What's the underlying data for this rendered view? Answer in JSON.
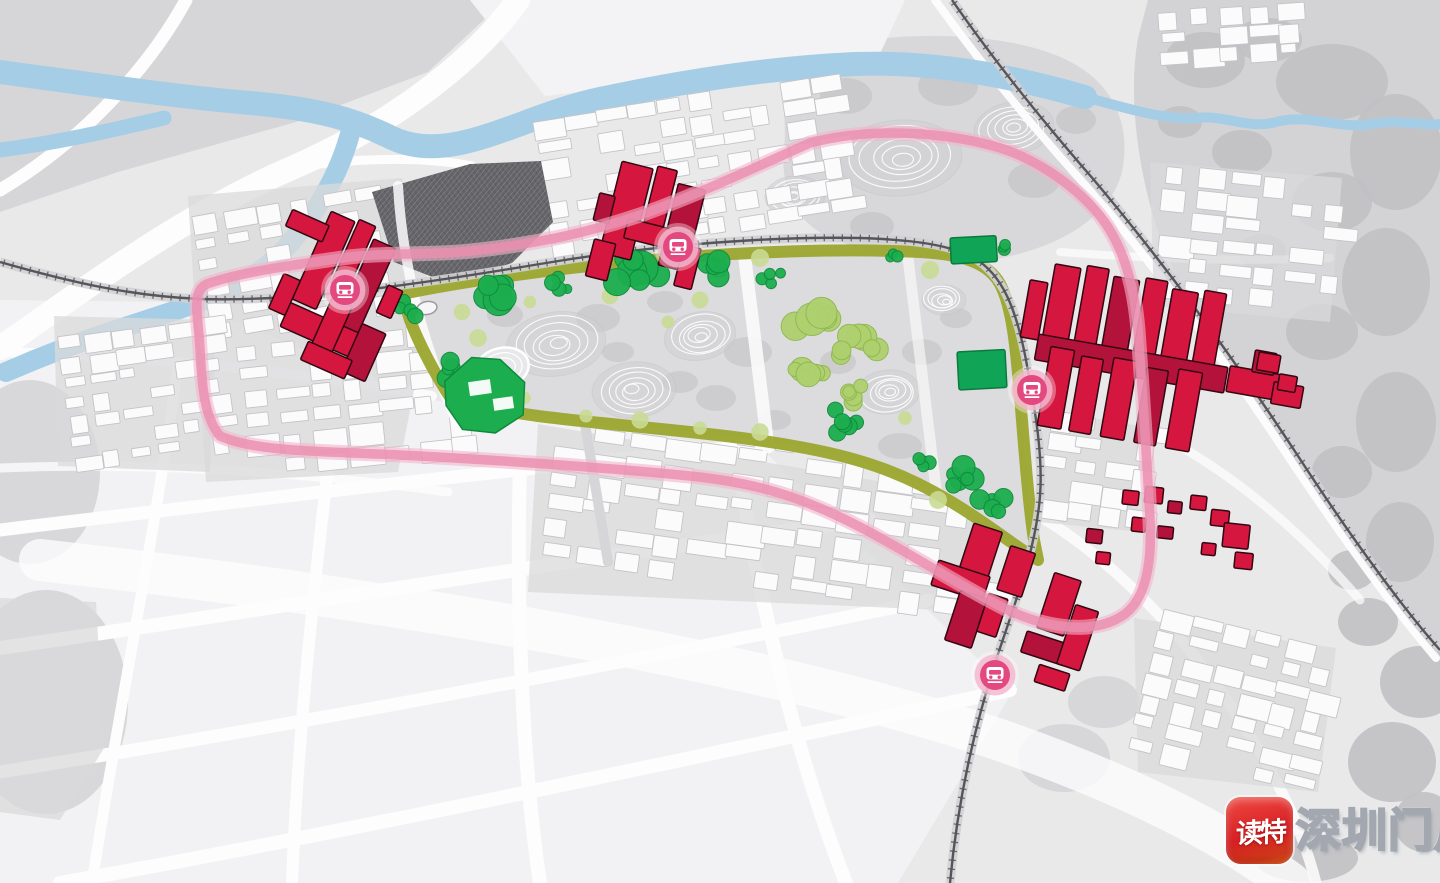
{
  "title": "urban-park-masterplan-rendering",
  "colors": {
    "background": "#e9e9ea",
    "terrain_gray": "#d6d6d8",
    "blob_gray": "#c1c1c4",
    "park_fill": "#dcdcde",
    "river_blue": "#a6cde6",
    "road_white": "#fdfdfe",
    "rail_dark": "#55555a",
    "rail_bed": "#d2d2d5",
    "pink_line": "#eb8fb0",
    "pink_line_soft": "#f2b4ca",
    "greenway_olive": "#9da733",
    "tree_green": "#1cae4e",
    "tree_green_dark": "#0f8a3c",
    "tree_light": "#aed06e",
    "tree_light_blob": "#c9da93",
    "green_building": "#10a556",
    "red_building": "#d5163e",
    "red_building_dark": "#b3123a",
    "building_outline": "#320712",
    "station_pink": "#e3487f",
    "station_ring": "#f4b6cd",
    "white_block": "#fbfbfc",
    "white_block_outline": "#c4c4c8",
    "village_dark": "#66666a",
    "parcel_gray": "#d9d9db"
  },
  "watermark": {
    "app_name": "读特",
    "site_name": "深圳门户"
  },
  "transit": {
    "stations": [
      {
        "id": "west-station",
        "x": 345,
        "y": 290
      },
      {
        "id": "north-station",
        "x": 678,
        "y": 247
      },
      {
        "id": "east-station",
        "x": 1032,
        "y": 390
      },
      {
        "id": "south-station",
        "x": 995,
        "y": 675
      }
    ]
  },
  "park": {
    "hills": [
      [
        556,
        344,
        50,
        32,
        -8
      ],
      [
        634,
        390,
        42,
        28,
        -5
      ],
      [
        700,
        336,
        36,
        24,
        -10
      ],
      [
        888,
        392,
        32,
        22,
        -6
      ],
      [
        944,
        300,
        22,
        15,
        0
      ]
    ],
    "gray_blobs": [
      [
        505,
        315,
        18,
        12
      ],
      [
        598,
        318,
        22,
        14
      ],
      [
        665,
        302,
        18,
        11
      ],
      [
        748,
        352,
        24,
        15
      ],
      [
        716,
        398,
        20,
        13
      ],
      [
        775,
        420,
        16,
        10
      ],
      [
        838,
        362,
        18,
        12
      ],
      [
        922,
        352,
        20,
        13
      ],
      [
        956,
        318,
        16,
        10
      ],
      [
        900,
        446,
        22,
        13
      ],
      [
        618,
        352,
        16,
        10
      ],
      [
        680,
        382,
        18,
        11
      ]
    ],
    "tree_clusters_dark": [
      [
        500,
        291,
        24,
        7
      ],
      [
        560,
        283,
        13,
        4
      ],
      [
        636,
        270,
        26,
        8
      ],
      [
        716,
        266,
        18,
        6
      ],
      [
        772,
        276,
        12,
        4
      ],
      [
        412,
        308,
        14,
        5
      ],
      [
        452,
        370,
        15,
        5
      ],
      [
        838,
        420,
        20,
        6
      ],
      [
        962,
        478,
        18,
        6
      ],
      [
        992,
        502,
        16,
        5
      ],
      [
        930,
        462,
        12,
        4
      ],
      [
        1002,
        248,
        10,
        3
      ],
      [
        340,
        340,
        10,
        3
      ],
      [
        892,
        254,
        9,
        3
      ]
    ],
    "tree_clusters_light": [
      [
        818,
        318,
        26,
        7
      ],
      [
        862,
        348,
        24,
        7
      ],
      [
        806,
        372,
        20,
        6
      ],
      [
        850,
        392,
        16,
        5
      ]
    ],
    "light_blobs": [
      [
        462,
        312
      ],
      [
        530,
        302
      ],
      [
        610,
        296
      ],
      [
        668,
        322
      ],
      [
        700,
        300
      ],
      [
        586,
        416
      ],
      [
        640,
        420
      ],
      [
        700,
        428
      ],
      [
        760,
        432
      ],
      [
        524,
        398
      ],
      [
        478,
        338
      ],
      [
        905,
        418
      ],
      [
        938,
        500
      ],
      [
        600,
        262
      ],
      [
        760,
        258
      ],
      [
        690,
        256
      ],
      [
        930,
        270
      ]
    ],
    "green_buildings": [
      [
        950,
        238,
        46,
        26,
        -3
      ],
      [
        957,
        352,
        48,
        38,
        -3
      ]
    ],
    "running_track": {
      "cx": 502,
      "cy": 368,
      "rx": 27,
      "ry": 20,
      "rot": -14
    },
    "pond": {
      "cx": 427,
      "cy": 308,
      "rx": 10,
      "ry": 6.5,
      "rot": -10
    }
  },
  "terrain": {
    "north_hills": [
      [
        900,
        158,
        62,
        38,
        -4
      ],
      [
        1014,
        128,
        40,
        26,
        -8
      ],
      [
        795,
        196,
        30,
        20,
        -4
      ]
    ],
    "north_blobs": [
      [
        846,
        96,
        26,
        18
      ],
      [
        948,
        86,
        30,
        20
      ],
      [
        1034,
        180,
        26,
        18
      ],
      [
        872,
        226,
        22,
        14
      ],
      [
        1076,
        120,
        20,
        14
      ]
    ],
    "east_canopy_blobs": [
      [
        1205,
        60,
        40,
        28
      ],
      [
        1268,
        40,
        34,
        22
      ],
      [
        1332,
        82,
        56,
        38
      ],
      [
        1396,
        152,
        46,
        58
      ],
      [
        1332,
        202,
        40,
        30
      ],
      [
        1242,
        152,
        30,
        22
      ],
      [
        1386,
        282,
        44,
        54
      ],
      [
        1322,
        332,
        36,
        28
      ],
      [
        1396,
        422,
        40,
        50
      ],
      [
        1342,
        472,
        30,
        26
      ],
      [
        1400,
        542,
        34,
        40
      ],
      [
        1262,
        252,
        24,
        18
      ],
      [
        1222,
        212,
        20,
        16
      ],
      [
        1180,
        122,
        22,
        16
      ],
      [
        1368,
        622,
        30,
        24
      ],
      [
        1420,
        682,
        40,
        36
      ],
      [
        1392,
        762,
        44,
        40
      ],
      [
        1306,
        858,
        52,
        24
      ],
      [
        1424,
        822,
        30,
        30
      ],
      [
        1352,
        570,
        24,
        20
      ]
    ],
    "misc_blobs": [
      [
        30,
        472,
        70,
        92
      ],
      [
        46,
        702,
        82,
        112
      ],
      [
        1064,
        758,
        46,
        34
      ],
      [
        1104,
        702,
        36,
        26
      ]
    ]
  },
  "red_clusters": [
    {
      "id": "west-cluster",
      "rot": 24,
      "cx": 340,
      "cy": 295,
      "bars": [
        [
          298,
          222,
          26,
          96
        ],
        [
          327,
          218,
          18,
          70
        ],
        [
          348,
          230,
          24,
          102
        ],
        [
          298,
          322,
          88,
          26
        ],
        [
          334,
          300,
          22,
          62
        ],
        [
          280,
          298,
          18,
          38
        ],
        [
          372,
          312,
          26,
          52
        ],
        [
          330,
          350,
          48,
          20
        ],
        [
          380,
          266,
          16,
          30
        ],
        [
          262,
          236,
          40,
          18
        ]
      ]
    },
    {
      "id": "north-cluster",
      "rot": 14,
      "cx": 652,
      "cy": 215,
      "bars": [
        [
          610,
          170,
          32,
          94
        ],
        [
          646,
          166,
          20,
          58
        ],
        [
          670,
          178,
          28,
          84
        ],
        [
          602,
          252,
          22,
          38
        ],
        [
          630,
          224,
          60,
          20
        ],
        [
          690,
          236,
          18,
          42
        ],
        [
          596,
          206,
          16,
          28
        ]
      ]
    },
    {
      "id": "east-cluster",
      "rot": 10,
      "cx": 1140,
      "cy": 360,
      "bars": [
        [
          1040,
          280,
          26,
          88
        ],
        [
          1072,
          276,
          22,
          92
        ],
        [
          1100,
          282,
          26,
          86
        ],
        [
          1132,
          278,
          22,
          90
        ],
        [
          1160,
          284,
          26,
          84
        ],
        [
          1192,
          280,
          22,
          88
        ],
        [
          1036,
          352,
          192,
          26
        ],
        [
          1050,
          362,
          24,
          80
        ],
        [
          1082,
          366,
          22,
          76
        ],
        [
          1114,
          362,
          24,
          80
        ],
        [
          1148,
          366,
          22,
          76
        ],
        [
          1180,
          362,
          24,
          80
        ],
        [
          1018,
          300,
          18,
          58
        ],
        [
          1230,
          350,
          66,
          26
        ],
        [
          1252,
          330,
          22,
          22
        ],
        [
          1276,
          358,
          30,
          22
        ]
      ]
    },
    {
      "id": "south-cluster",
      "rot": 18,
      "cx": 1010,
      "cy": 600,
      "bars": [
        [
          952,
          538,
          30,
          62
        ],
        [
          930,
          584,
          54,
          26
        ],
        [
          960,
          606,
          28,
          52
        ],
        [
          994,
          548,
          26,
          46
        ],
        [
          988,
          600,
          20,
          40
        ],
        [
          1044,
          560,
          28,
          58
        ],
        [
          1036,
          624,
          46,
          22
        ],
        [
          1074,
          584,
          24,
          62
        ],
        [
          1058,
          652,
          32,
          18
        ]
      ]
    },
    {
      "id": "villa-cluster",
      "rot": 6,
      "cx": 1180,
      "cy": 525,
      "bars": [
        [
          1120,
          496,
          16,
          14
        ],
        [
          1142,
          490,
          18,
          16
        ],
        [
          1166,
          502,
          14,
          12
        ],
        [
          1188,
          494,
          16,
          14
        ],
        [
          1210,
          506,
          18,
          16
        ],
        [
          1132,
          522,
          14,
          14
        ],
        [
          1158,
          528,
          16,
          12
        ],
        [
          1224,
          518,
          26,
          24
        ],
        [
          1238,
          546,
          18,
          16
        ],
        [
          1204,
          540,
          14,
          12
        ],
        [
          1088,
          538,
          16,
          14
        ],
        [
          1100,
          560,
          14,
          12
        ]
      ]
    },
    {
      "id": "east-annex",
      "rot": 10,
      "cx": 1270,
      "cy": 372,
      "bars": [
        [
          1256,
          354,
          22,
          18
        ],
        [
          1280,
          372,
          18,
          16
        ]
      ]
    }
  ]
}
